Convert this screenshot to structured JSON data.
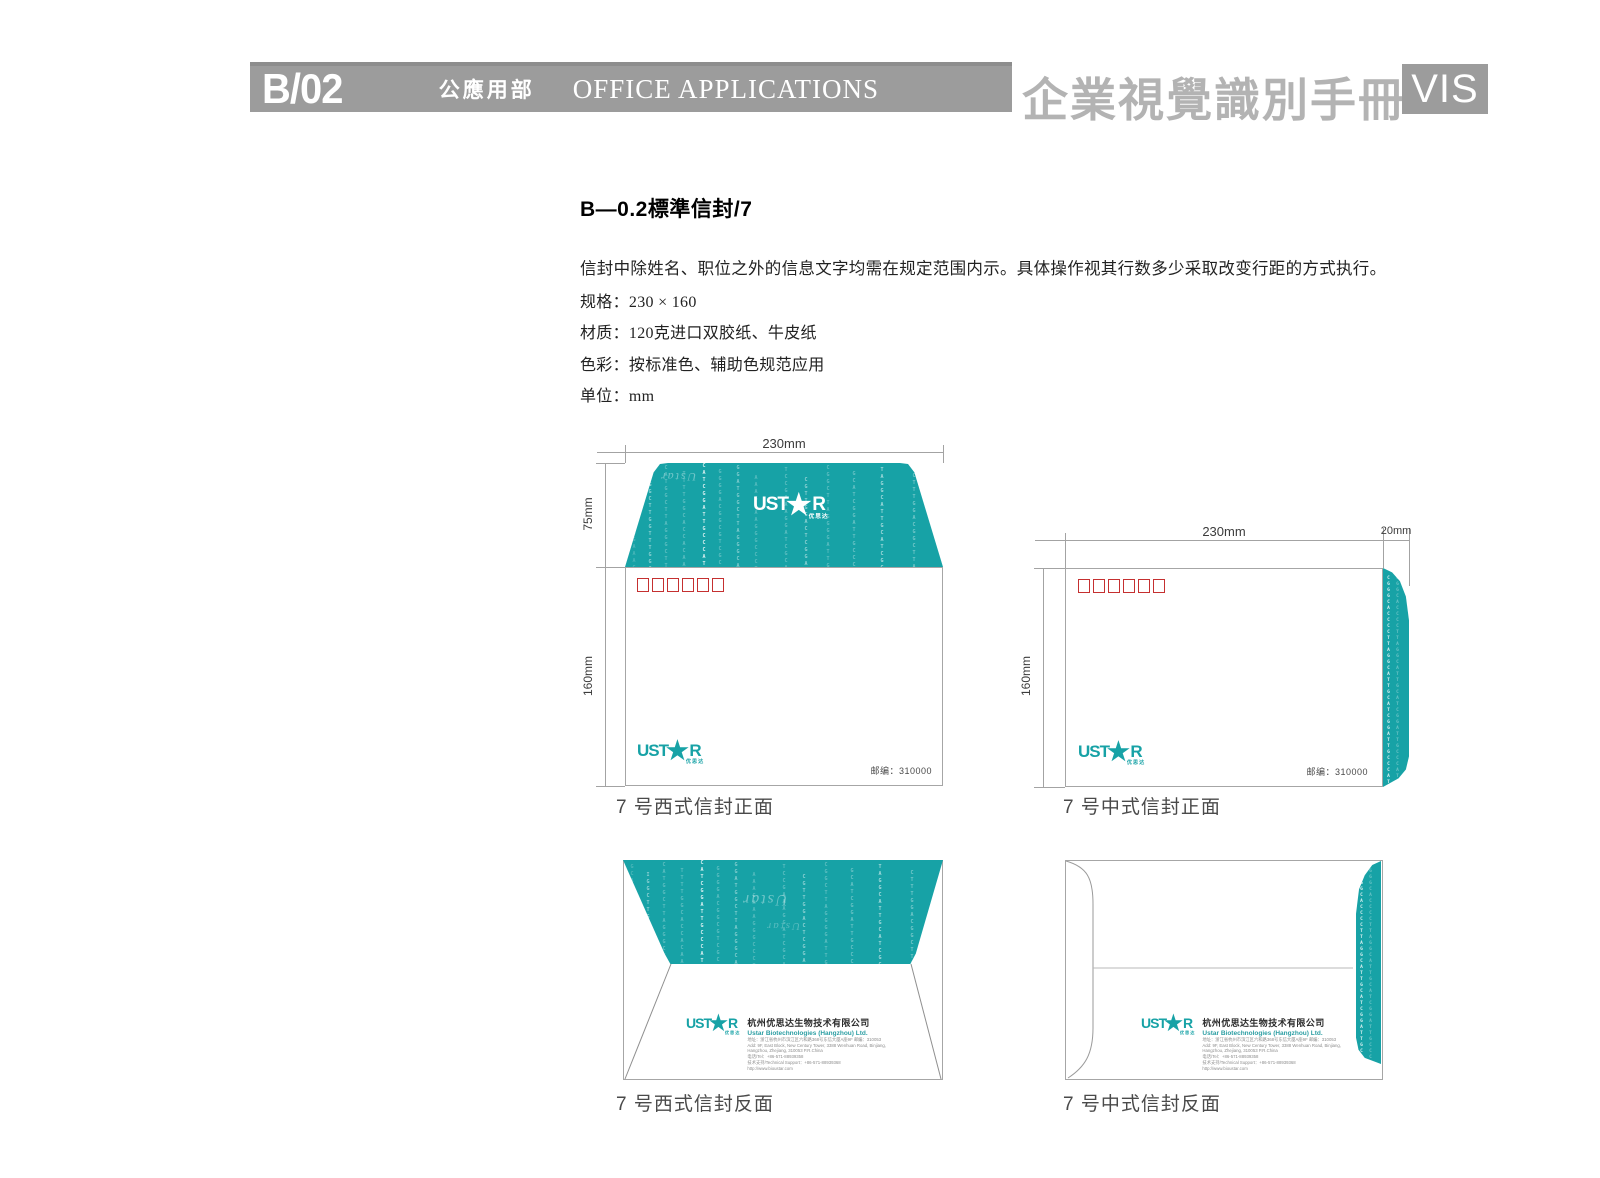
{
  "header": {
    "code": "B/02",
    "dept_cn": "公應用部",
    "dept_en": "OFFICE APPLICATIONS",
    "manual_cn": "企業視覺識別手冊",
    "badge": "VIS"
  },
  "content": {
    "title": "B—0.2標準信封/7",
    "description": "信封中除姓名、职位之外的信息文字均需在规定范围内示。具体操作视其行数多少采取改变行距的方式执行。",
    "specs": [
      "规格：230 × 160",
      "材质：120克进口双胶纸、牛皮纸",
      "色彩：按标准色、辅助色规范应用",
      "单位：mm"
    ]
  },
  "brand": {
    "logo_left": "UST",
    "logo_star": "★",
    "logo_right": "R",
    "logo_sub": "优思达",
    "teal": "#17a2a6"
  },
  "envelopes": {
    "west_front": {
      "caption": "7 号西式信封正面",
      "dim_width": "230mm",
      "dim_flap": "75mm",
      "dim_height": "160mm",
      "postcode": "邮编：310000"
    },
    "china_front": {
      "caption": "7 号中式信封正面",
      "dim_width": "230mm",
      "dim_side": "20mm",
      "dim_height": "160mm",
      "postcode": "邮编：310000"
    },
    "west_back": {
      "caption": "7 号西式信封反面"
    },
    "china_back": {
      "caption": "7 号中式信封反面"
    }
  },
  "company": {
    "name_cn": "杭州优思达生物技术有限公司",
    "name_en": "Ustar Biotechnologies (Hangzhou) Ltd.",
    "lines": [
      "地址：浙江省杭州市滨江区六和路368号东信大厦A座9F  邮编：310053",
      "Add: 9F, East Block, New Century Tower, 3388 Wenhuan Road, Binjiang,",
      "Hangzhou, Zhejiang, 310053 P.R.China",
      "电话/Tel：+86-571-88939358",
      "技术支持/Technical Support：+86-571-88939368",
      "http://www.bioustar.com"
    ]
  },
  "dna": {
    "watermark": "Ustar",
    "columns": [
      "GCACACCAAAGAAAGGGCCC",
      "IGGCTTGGTTTGGCAGCGG",
      "CATGGCTTAGGGCTTGGTA",
      "TTTTGGCACCACAACGACGTTG",
      "CATCGGATTGCCCATGGCTTAGG",
      "GGGGACGGCGTCGCACACCA",
      "GGATGGCTTAGGGCATGGCTTAG",
      "AAAGAAAGGGCCCTTAGG",
      "TCCGAAAGGATCGCATTGCAT",
      "CGTTGGACTCGGACTGGCATGG",
      "CGGCTTAGGGGATTGCACTTGA",
      "GCATCGGATTGCCCATGCATGA",
      "TAGGCATTGCATCGGATTGCC",
      "CTTTGGACGGCTTAGGCATTGC"
    ],
    "strip": "CGGGCACCCCTTAGGCATTGCATCGGATTGCCCATGCCATGGCTTAGGGCTTG"
  }
}
